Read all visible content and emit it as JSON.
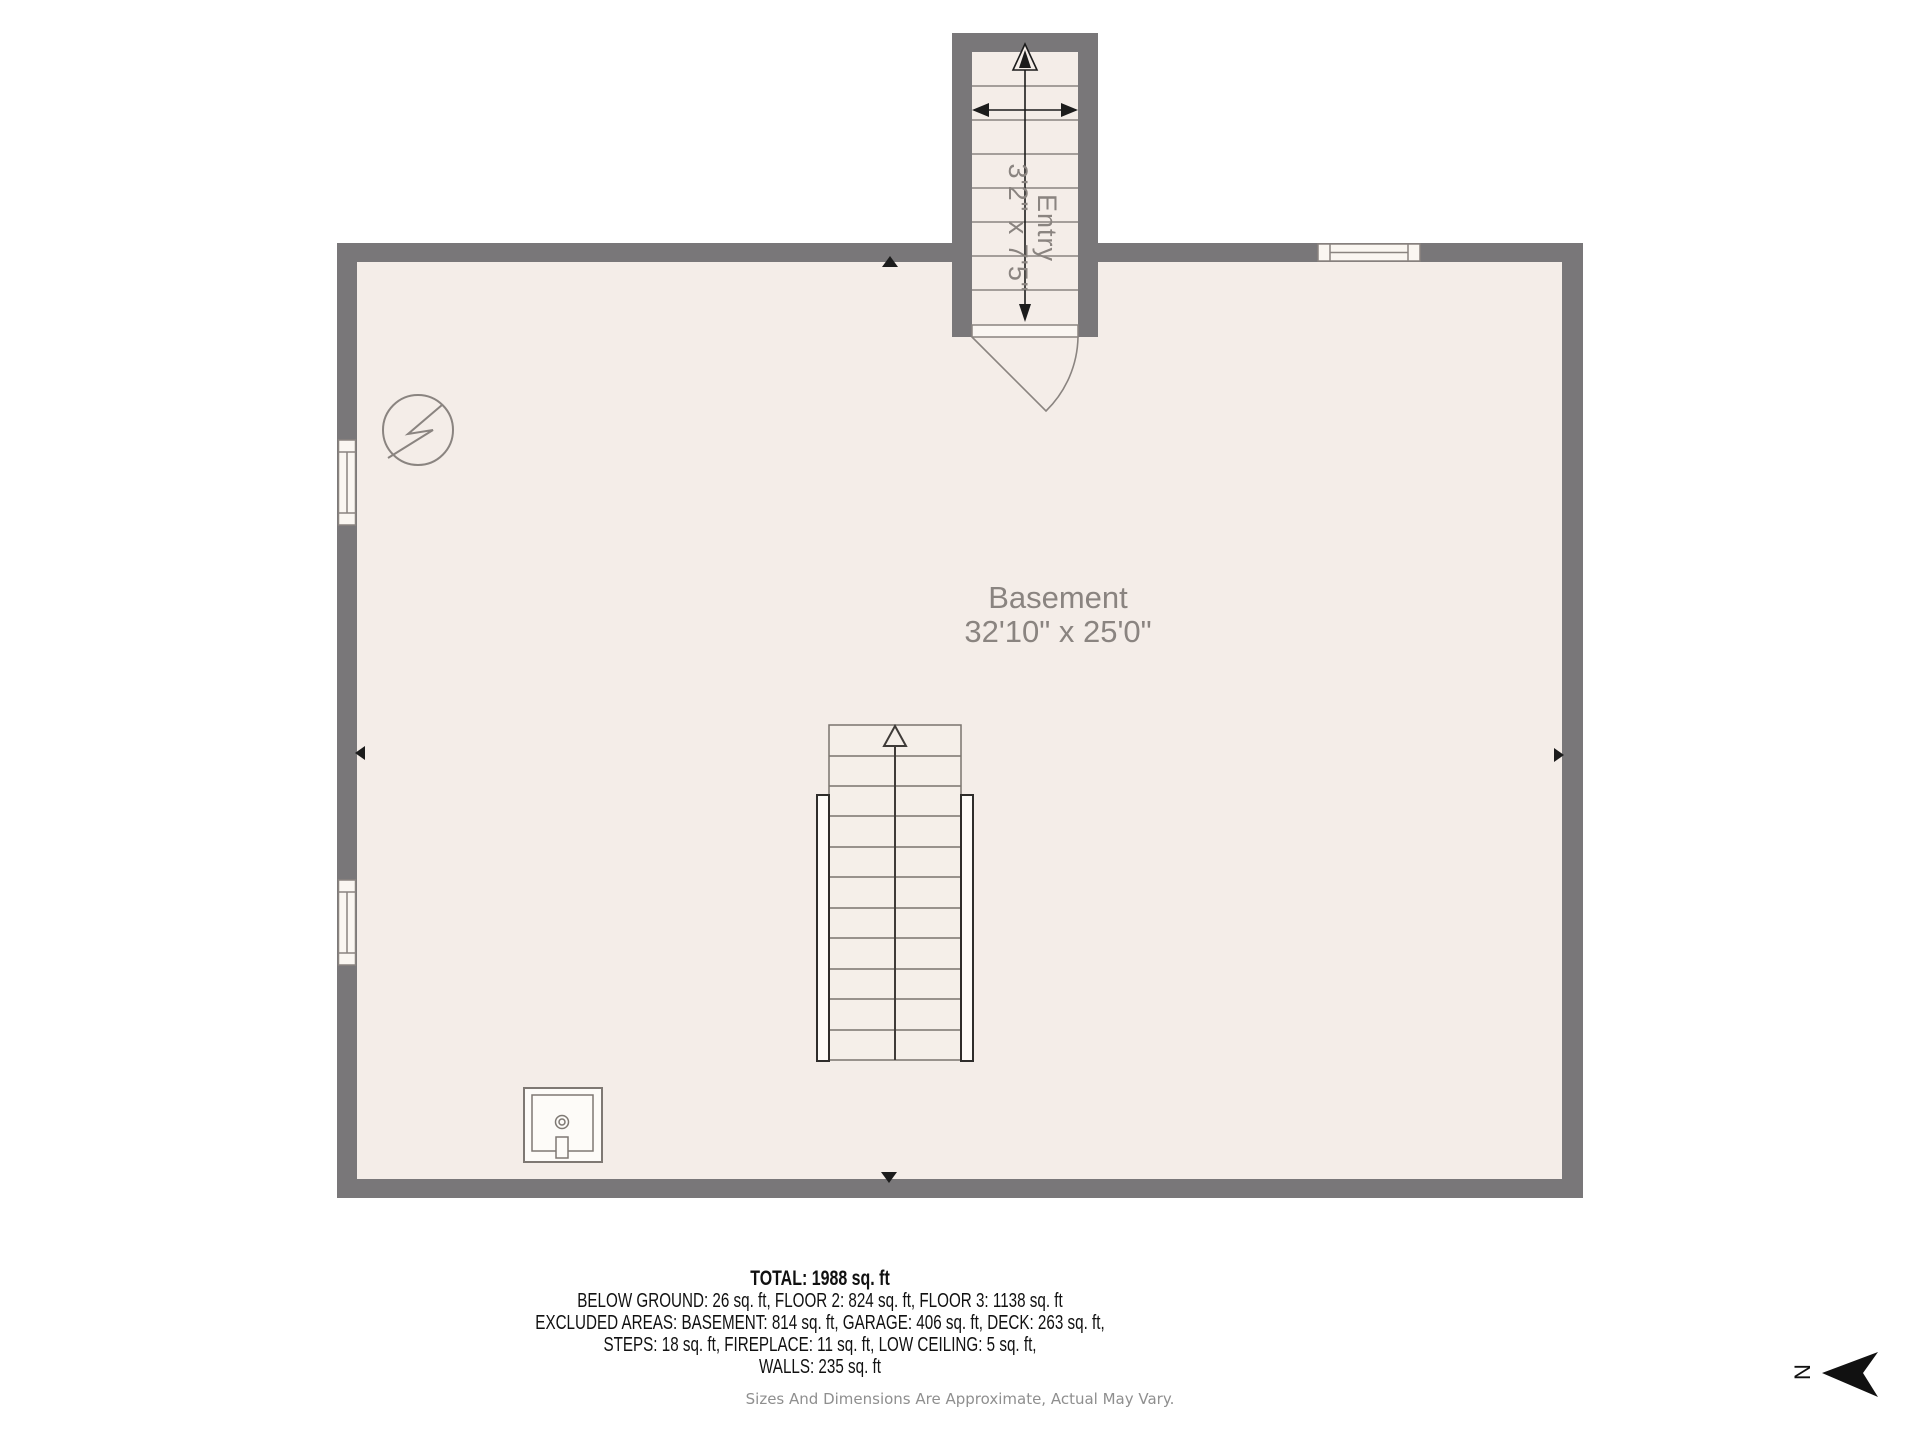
{
  "floorplan": {
    "rooms": {
      "basement": {
        "name": "Basement",
        "dimensions": "32'10\" x 25'0\""
      },
      "entry": {
        "name": "Entry",
        "dimensions": "3'2\" x 7'5\""
      }
    },
    "features": {
      "entry_staircase": "staircase-up-icon",
      "main_staircase": "staircase-up-icon",
      "entry_door": "door-swing-icon",
      "electrical_panel": "electrical-panel-icon",
      "utility_sink": "utility-sink-icon",
      "windows": [
        "left-wall-window-upper",
        "left-wall-window-lower",
        "top-wall-window"
      ]
    },
    "colors": {
      "wall": "#797779",
      "floor": "#f4ede8",
      "line_muted": "#8a8480",
      "line_dark": "#2f2d2b",
      "arrow_black": "#1c1c1c",
      "label_muted": "#8a8480",
      "summary_text": "#111111",
      "disclaimer_text": "#8f8f8f",
      "background": "#ffffff"
    }
  },
  "summary": {
    "total": "TOTAL: 1988 sq. ft",
    "line_floors": "BELOW GROUND: 26 sq. ft, FLOOR 2: 824 sq. ft, FLOOR 3: 1138 sq. ft",
    "line_excluded_1": "EXCLUDED AREAS: BASEMENT: 814 sq. ft, GARAGE: 406 sq. ft, DECK: 263 sq. ft,",
    "line_excluded_2": "STEPS: 18 sq. ft, FIREPLACE: 11 sq. ft, LOW CEILING: 5 sq. ft,",
    "line_walls": "WALLS: 235 sq. ft"
  },
  "disclaimer": "Sizes And Dimensions Are Approximate, Actual May Vary.",
  "compass": {
    "label": "N"
  }
}
